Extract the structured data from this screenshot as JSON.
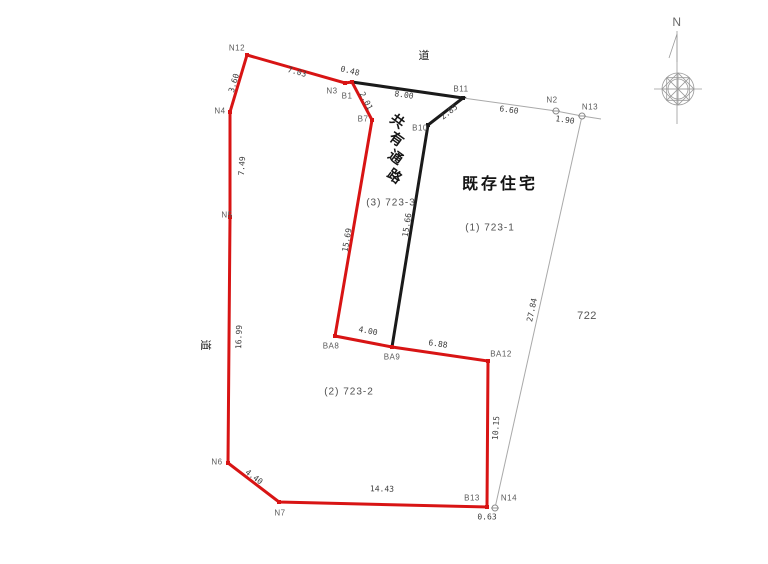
{
  "diagram": {
    "compass_north": "N",
    "roads": {
      "top": "道",
      "left": "道"
    },
    "parcels": {
      "passage_name": "共有通路",
      "passage_number": "(3) 723-3",
      "house_name": "既存住宅",
      "parcel1_number": "(1) 723-1",
      "parcel2_number": "(2) 723-2",
      "adjacent_lot": "722"
    },
    "points": {
      "n12": "N12",
      "n3": "N3",
      "b1": "B1",
      "b7": "B7",
      "b11": "B11",
      "b10": "B10",
      "n2": "N2",
      "n13": "N13",
      "n4": "N4",
      "n5": "N5",
      "n6": "N6",
      "n7": "N7",
      "ba8": "BA8",
      "ba9": "BA9",
      "ba12": "BA12",
      "b13": "B13",
      "n14": "N14"
    },
    "dimensions": {
      "n12_n3": "7.03",
      "n3_b1": "0.48",
      "b1_b7": "2.01",
      "b1_b11": "8.00",
      "b11_b10": "2.85",
      "b11_n2": "6.60",
      "n2_n13": "1.90",
      "b7_ba8": "15.69",
      "b10_ba9": "15.66",
      "ba8_ba9": "4.00",
      "ba9_ba12": "6.88",
      "ba12_b13": "10.15",
      "n13_n14": "27.84",
      "n5_n6": "16.99",
      "n4_n5": "7.49",
      "n12_n4": "3.60",
      "n6_n7": "4.40",
      "n7_b13": "14.43",
      "b13_n14": "0.63"
    },
    "colors": {
      "boundary_red": "#d81414",
      "passage_black": "#1a1a1a",
      "reference_gray": "#a9a9a9"
    }
  }
}
